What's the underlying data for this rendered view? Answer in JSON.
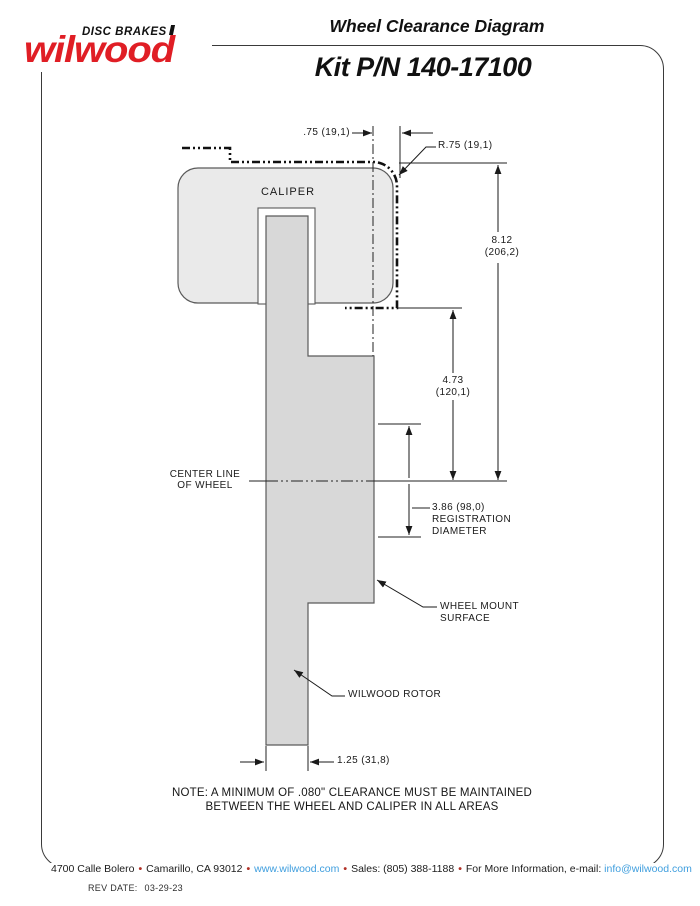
{
  "header": {
    "brand_tagline": "DISC BRAKES",
    "brand_wordmark": "wilwood",
    "title": "Wheel Clearance Diagram",
    "kit_number": "Kit P/N 140-17100"
  },
  "diagram": {
    "caliper_label": "CALIPER",
    "dim_caliper_clearance": ".75 (19,1)",
    "dim_corner_radius": "R.75 (19,1)",
    "dim_overall_height_in": "8.12",
    "dim_overall_height_mm": "(206,2)",
    "dim_caliper_to_centerline_in": "4.73",
    "dim_caliper_to_centerline_mm": "(120,1)",
    "centerline_line1": "CENTER LINE",
    "centerline_line2": "OF WHEEL",
    "registration_dim": "3.86 (98,0)",
    "registration_line1": "REGISTRATION",
    "registration_line2": "DIAMETER",
    "wheel_mount_line1": "WHEEL MOUNT",
    "wheel_mount_line2": "SURFACE",
    "rotor_label": "WILWOOD ROTOR",
    "dim_rotor_width": "1.25 (31,8)"
  },
  "note": {
    "line1": "NOTE: A MINIMUM OF .080\" CLEARANCE MUST BE MAINTAINED",
    "line2": "BETWEEN THE WHEEL AND CALIPER IN ALL AREAS"
  },
  "footer": {
    "address": "4700 Calle Bolero",
    "city": "Camarillo, CA 93012",
    "website": "www.wilwood.com",
    "sales": "Sales: (805) 388-1188",
    "info_prefix": "For More Information, e-mail:",
    "email": "info@wilwood.com",
    "separator": "•",
    "rev_date_label": "REV DATE:",
    "rev_date": "03-29-23"
  }
}
